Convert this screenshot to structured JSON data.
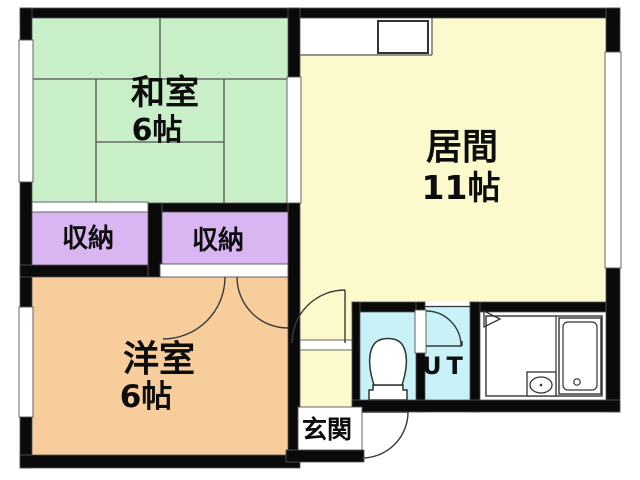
{
  "plan": {
    "type": "floor-plan",
    "rooms": {
      "washitsu": {
        "label": "和室",
        "size": "6帖"
      },
      "ima": {
        "label": "居間",
        "size": "11帖"
      },
      "yoshitsu": {
        "label": "洋室",
        "size": "6帖"
      },
      "closet_left": {
        "label": "収納"
      },
      "closet_right": {
        "label": "収納"
      },
      "genkan": {
        "label": "玄関"
      },
      "ut": {
        "label": "UT"
      }
    },
    "colors": {
      "tatami_room": "#c9efc8",
      "living_room": "#fcfacd",
      "western_room": "#f7cd9b",
      "closet": "#d9b6f2",
      "wet_area": "#c9f2f8",
      "bath": "#ffffff",
      "wall": "#0a0a0a"
    }
  }
}
